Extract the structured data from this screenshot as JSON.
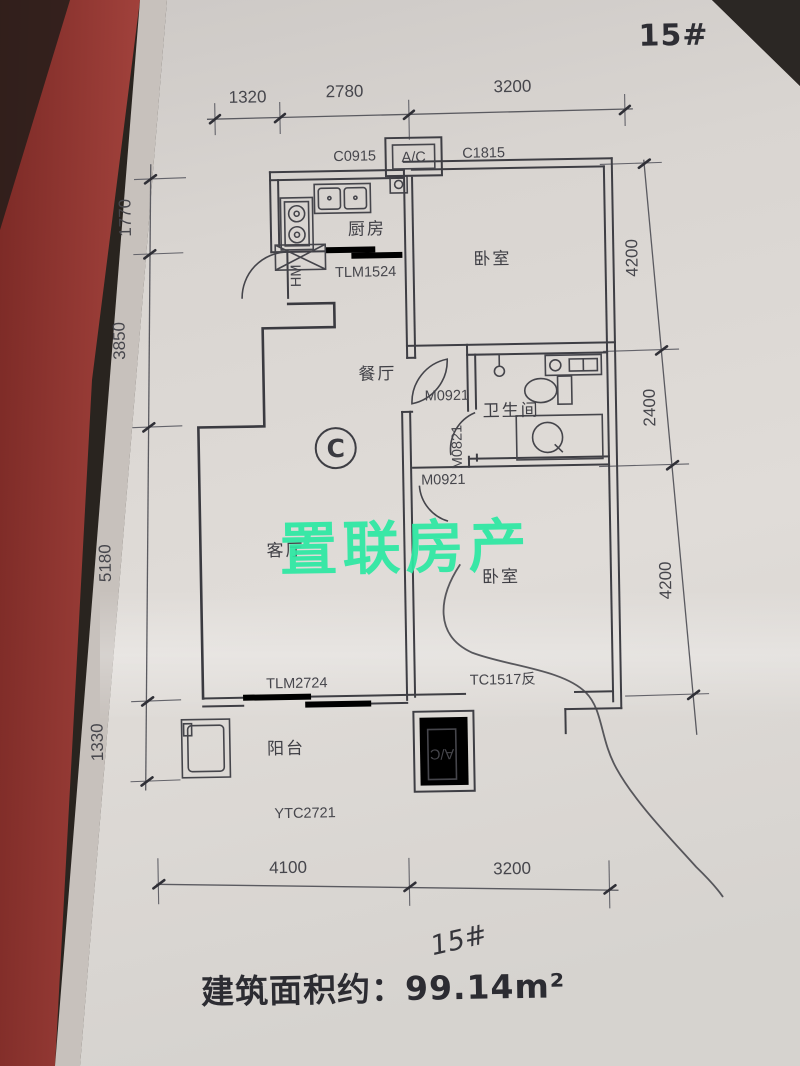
{
  "header": {
    "unit_number": "15#"
  },
  "watermark": {
    "text": "置联房产",
    "color": "#2de8a3"
  },
  "footer": {
    "handwritten_unit": "15#",
    "area_label": "建筑面积约：99.14m²"
  },
  "plan": {
    "unit_type_badge": "C",
    "rooms": {
      "kitchen": "厨房",
      "bedroom_top": "卧室",
      "dining": "餐厅",
      "bathroom": "卫生间",
      "living": "客厅",
      "bedroom_bottom": "卧室",
      "balcony": "阳台"
    },
    "openings": {
      "kitchen_window": "C0915",
      "ac_top": "A/C",
      "bedroom_top_window": "C1815",
      "kitchen_door": "TLM1524",
      "entry_door": "HM",
      "hall_door": "M0921",
      "bathroom_door": "M0821",
      "bedroom_bottom_door": "M0921",
      "living_balcony_door": "TLM2724",
      "bedroom_bottom_window": "TC1517反",
      "balcony_window": "YTC2721",
      "ac_bottom": "A/C"
    },
    "dimensions": {
      "top": [
        "1320",
        "2780",
        "3200"
      ],
      "left": [
        "1770",
        "3850",
        "5180",
        "1330"
      ],
      "right": [
        "4200",
        "2400",
        "4200"
      ],
      "bottom": [
        "4100",
        "3200"
      ]
    }
  },
  "colors": {
    "paper": "#ddd9d5",
    "red_folder": "#96362f",
    "ink": "#3e3e44",
    "watermark_green": "#2de8a3"
  }
}
